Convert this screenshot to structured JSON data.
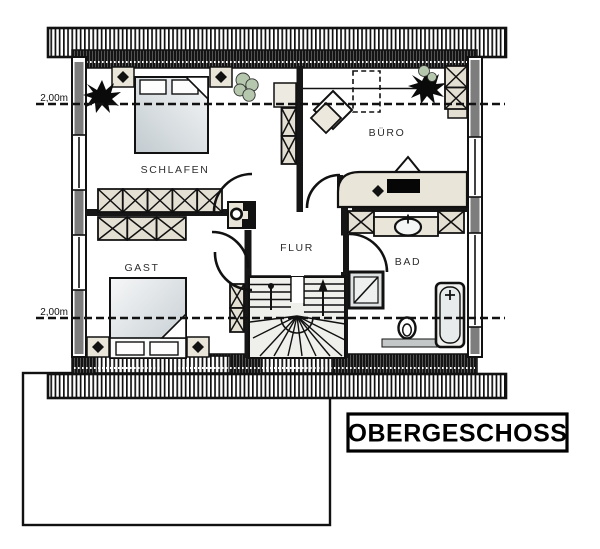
{
  "title": "OBERGESCHOSS",
  "plan": {
    "rooms": [
      {
        "name": "SCHLAFEN"
      },
      {
        "name": "BÜRO"
      },
      {
        "name": "GAST"
      },
      {
        "name": "FLUR"
      },
      {
        "name": "BAD"
      }
    ],
    "dimension_labels": [
      {
        "text": "2,00m"
      },
      {
        "text": "2,00m"
      }
    ],
    "colors": {
      "wall_hatch": "#111111",
      "wall_gray": "#7d7d7d",
      "furniture_beige": "#e4dfd3",
      "bed_gray": "#c5cdd2",
      "plant_green": "#b5c7ad",
      "background": "#ffffff"
    },
    "furniture_icons": [
      "double-bed-icon",
      "single-bed-icon",
      "wardrobe-icon",
      "nightstand-icon",
      "plant-icon",
      "roof-window-icon",
      "desk-icon",
      "monitor-icon",
      "office-chair-icon",
      "cabinet-icon",
      "washbasin-icon",
      "shower-icon",
      "bathtub-icon",
      "toilet-icon",
      "stairs-icon",
      "chimney-icon"
    ]
  }
}
